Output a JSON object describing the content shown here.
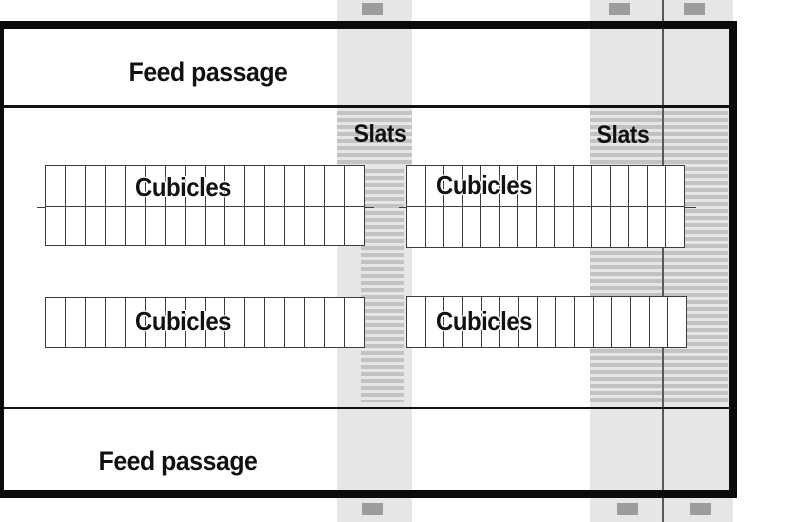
{
  "diagram": {
    "type": "barn-floor-plan",
    "labels": {
      "feed_passage_top": "Feed passage",
      "feed_passage_bottom": "Feed passage",
      "slats_left": "Slats",
      "slats_right": "Slats",
      "cubicles_top_left": "Cubicles",
      "cubicles_top_right": "Cubicles",
      "cubicles_bottom_left": "Cubicles",
      "cubicles_bottom_right": "Cubicles"
    },
    "colors": {
      "band": "#e6e6e6",
      "stripe": "#c3c3c3",
      "marker": "#9c9c9c",
      "vline": "#5a5a5a",
      "wall": "#0b0b0b",
      "cell": "#3c3c3c"
    },
    "cubicle_blocks": [
      {
        "id": "top-left",
        "rows": 2,
        "cols": 16
      },
      {
        "id": "top-right",
        "rows": 2,
        "cols": 15
      },
      {
        "id": "bottom-left",
        "rows": 1,
        "cols": 16
      },
      {
        "id": "bottom-right",
        "rows": 1,
        "cols": 15
      }
    ],
    "passage_markers": {
      "top_count": 3,
      "bottom_count": 3
    }
  }
}
